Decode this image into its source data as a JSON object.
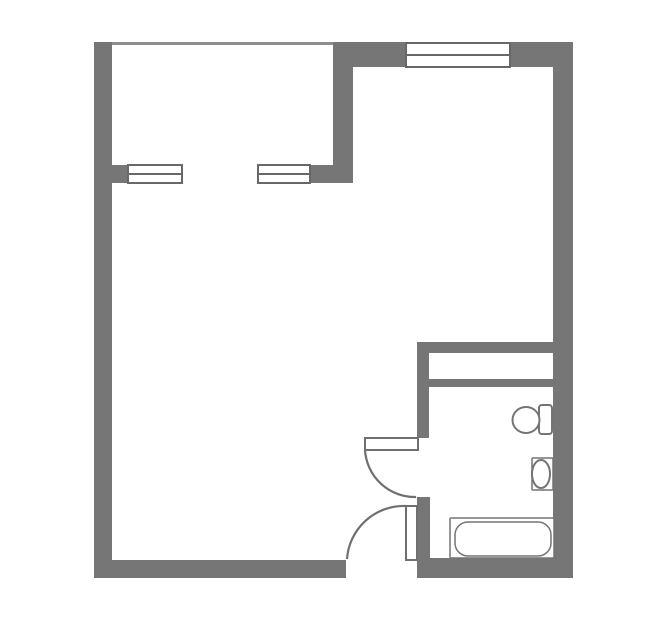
{
  "plan": {
    "canvas": {
      "width": 664,
      "height": 629,
      "background": "#ffffff"
    },
    "colors": {
      "wall": "#767676",
      "open_edge": "#8e8e8e",
      "window_frame": "#686868",
      "door": "#6f6f6f",
      "fixture": "#747474",
      "fill": "#ffffff"
    },
    "walls": [
      {
        "name": "left-wall",
        "x": 94,
        "y": 42,
        "w": 18,
        "h": 536
      },
      {
        "name": "bottom-wall",
        "x": 94,
        "y": 560,
        "w": 252,
        "h": 18
      },
      {
        "name": "right-wall",
        "x": 553,
        "y": 42,
        "w": 20,
        "h": 536
      },
      {
        "name": "top-wall-left-of-window",
        "x": 333,
        "y": 42,
        "w": 73,
        "h": 25
      },
      {
        "name": "top-wall-right-of-window",
        "x": 510,
        "y": 42,
        "w": 63,
        "h": 25
      },
      {
        "name": "balcony-divider-wall",
        "x": 333,
        "y": 42,
        "w": 20,
        "h": 141
      },
      {
        "name": "balcony-sill-stub-left",
        "x": 112,
        "y": 165,
        "w": 16,
        "h": 18
      },
      {
        "name": "balcony-sill-stub-right",
        "x": 310,
        "y": 165,
        "w": 43,
        "h": 18
      },
      {
        "name": "bathroom-top-wall",
        "x": 417,
        "y": 342,
        "w": 148,
        "h": 11
      },
      {
        "name": "bathroom-shaft-wall",
        "x": 429,
        "y": 379,
        "w": 124,
        "h": 8
      },
      {
        "name": "bathroom-left-wall-upper",
        "x": 417,
        "y": 342,
        "w": 12,
        "h": 96
      },
      {
        "name": "bathroom-left-wall-lower",
        "x": 417,
        "y": 497,
        "w": 13,
        "h": 81
      },
      {
        "name": "bathroom-bottom-wall",
        "x": 417,
        "y": 558,
        "w": 156,
        "h": 20
      }
    ],
    "open_edges": [
      {
        "name": "balcony-open-edge",
        "x": 112,
        "y": 42,
        "w": 221,
        "h": 3
      }
    ],
    "windows": [
      {
        "name": "balcony-window-left",
        "x": 128,
        "y": 165,
        "w": 54,
        "h": 18
      },
      {
        "name": "balcony-window-right",
        "x": 258,
        "y": 165,
        "w": 52,
        "h": 18
      },
      {
        "name": "top-window",
        "x": 406,
        "y": 43,
        "w": 104,
        "h": 24
      }
    ],
    "doors": [
      {
        "name": "bathroom-door",
        "leaf": {
          "x": 365,
          "y": 438,
          "w": 53,
          "h": 12
        },
        "arc": "M 365 450 A 50 50 0 0 0 416 497"
      },
      {
        "name": "entry-door",
        "leaf": {
          "x": 406,
          "y": 506,
          "w": 11,
          "h": 54
        },
        "arc": "M 347 559 A 57 57 0 0 1 406 506"
      }
    ],
    "fixtures": [
      {
        "name": "toilet-tank",
        "shape": "rect",
        "x": 539,
        "y": 405,
        "w": 13,
        "h": 29,
        "rx": 3,
        "sw": 2
      },
      {
        "name": "toilet-bowl",
        "shape": "ellipse",
        "cx": 526,
        "cy": 420,
        "rx": 13.5,
        "ry": 13,
        "sw": 2
      },
      {
        "name": "sink-counter",
        "shape": "rect",
        "x": 532,
        "y": 458,
        "w": 21,
        "h": 32,
        "rx": 1,
        "sw": 1.5
      },
      {
        "name": "sink-basin",
        "shape": "ellipse",
        "cx": 541,
        "cy": 474,
        "rx": 9,
        "ry": 14,
        "sw": 2
      },
      {
        "name": "bathtub-rim",
        "shape": "rect",
        "x": 450,
        "y": 518,
        "w": 104,
        "h": 40,
        "rx": 1,
        "sw": 1.5
      },
      {
        "name": "bathtub-basin",
        "shape": "rect",
        "x": 455,
        "y": 522,
        "w": 96,
        "h": 34,
        "rx": 13,
        "sw": 1.5
      }
    ]
  }
}
